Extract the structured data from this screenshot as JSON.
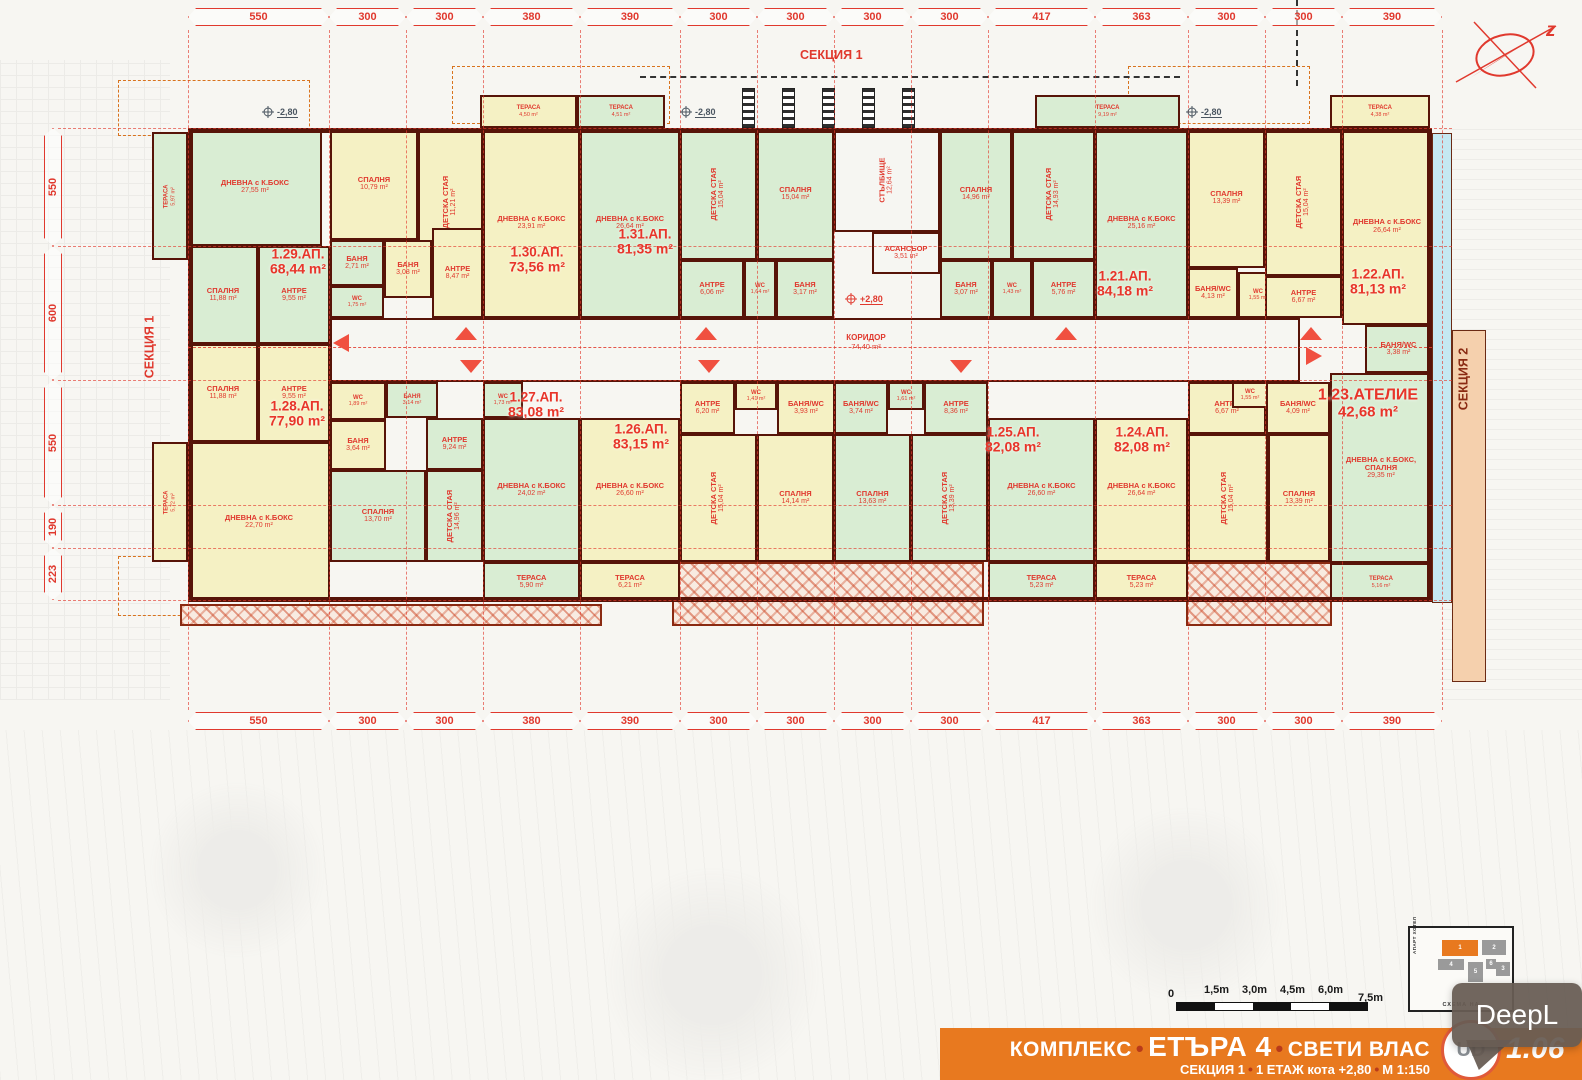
{
  "sections": {
    "top": "СЕКЦИЯ 1",
    "left": "СЕКЦИЯ 1",
    "right": "СЕКЦИЯ 2"
  },
  "north": {
    "letter": "z"
  },
  "dimensions": {
    "horizontal": [
      "550",
      "300",
      "300",
      "380",
      "390",
      "300",
      "300",
      "300",
      "300",
      "417",
      "363",
      "300",
      "300",
      "390"
    ],
    "vertical": [
      "550",
      "600",
      "550",
      "190",
      "223"
    ]
  },
  "elevations": {
    "minus": "-2,80",
    "plus": "+2,80"
  },
  "apartments": [
    {
      "id": "a29",
      "label": "1.29.АП.",
      "area": "68,44 m²"
    },
    {
      "id": "a30",
      "label": "1.30.АП.",
      "area": "73,56 m²"
    },
    {
      "id": "a31",
      "label": "1.31.АП.",
      "area": "81,35 m²"
    },
    {
      "id": "a21",
      "label": "1.21.АП.",
      "area": "84,18 m²"
    },
    {
      "id": "a22",
      "label": "1.22.АП.",
      "area": "81,13 m²"
    },
    {
      "id": "a23",
      "label": "1.23.АТЕЛИЕ",
      "area": "42,68 m²"
    },
    {
      "id": "a24",
      "label": "1.24.АП.",
      "area": "82,08 m²"
    },
    {
      "id": "a25",
      "label": "1.25.АП.",
      "area": "82,08 m²"
    },
    {
      "id": "a26",
      "label": "1.26.АП.",
      "area": "83,15 m²"
    },
    {
      "id": "a27",
      "label": "1.27.АП.",
      "area": "83,08 m²"
    },
    {
      "id": "a28",
      "label": "1.28.АП.",
      "area": "77,90 m²"
    }
  ],
  "rooms": [
    {
      "id": "ter597",
      "label": "ТЕРАСА",
      "area": "5,97 m²"
    },
    {
      "id": "r29dnev",
      "label": "ДНЕВНА с К.БОКС",
      "area": "27,55 m²"
    },
    {
      "id": "r29span",
      "label": "СПАЛНЯ",
      "area": "11,88 m²"
    },
    {
      "id": "r29antre",
      "label": "АНТРЕ",
      "area": "9,55 m²"
    },
    {
      "id": "r29banya",
      "label": "БАНЯ",
      "area": "2,71 m²"
    },
    {
      "id": "r29wc",
      "label": "WC",
      "area": "1,75 m²"
    },
    {
      "id": "r30span",
      "label": "СПАЛНЯ",
      "area": "10,79 m²"
    },
    {
      "id": "r30detska",
      "label": "ДЕТСКА СТАЯ",
      "area": "11,21 m²"
    },
    {
      "id": "r30antre",
      "label": "АНТРЕ",
      "area": "8,47 m²"
    },
    {
      "id": "r30banya",
      "label": "БАНЯ",
      "area": "3,08 m²"
    },
    {
      "id": "r30wc",
      "label": "WC",
      "area": "1,82 m²"
    },
    {
      "id": "r30ter",
      "label": "ТЕРАСА",
      "area": "4,50 m²"
    },
    {
      "id": "r30dnev",
      "label": "ДНЕВНА с К.БОКС",
      "area": "23,91 m²"
    },
    {
      "id": "r31ter",
      "label": "ТЕРАСА",
      "area": "4,51 m²"
    },
    {
      "id": "r31dnev",
      "label": "ДНЕВНА с К.БОКС",
      "area": "26,64 m²"
    },
    {
      "id": "r31detska",
      "label": "ДЕТСКА СТАЯ",
      "area": "15,04 m²"
    },
    {
      "id": "r31span",
      "label": "СПАЛНЯ",
      "area": "15,04 m²"
    },
    {
      "id": "r31antre",
      "label": "АНТРЕ",
      "area": "6,06 m²"
    },
    {
      "id": "r31wc",
      "label": "WC",
      "area": "1,64 m²"
    },
    {
      "id": "r31banya",
      "label": "БАНЯ",
      "area": "3,17 m²"
    },
    {
      "id": "stair",
      "label": "СТЪЛБИЩЕ",
      "area": "12,64 m²"
    },
    {
      "id": "lift",
      "label": "АСАНСЬОР",
      "area": "3,51 m²"
    },
    {
      "id": "corridor",
      "label": "",
      "area": ""
    },
    {
      "id": "r21span",
      "label": "СПАЛНЯ",
      "area": "14,96 m²"
    },
    {
      "id": "r21ter",
      "label": "ТЕРАСА",
      "area": "9,19 m²"
    },
    {
      "id": "r21detska",
      "label": "ДЕТСКА СТАЯ",
      "area": "14,93 m²"
    },
    {
      "id": "r21banya",
      "label": "БАНЯ",
      "area": "3,07 m²"
    },
    {
      "id": "r21wc",
      "label": "WC",
      "area": "1,43 m²"
    },
    {
      "id": "r21antre",
      "label": "АНТРЕ",
      "area": "5,76 m²"
    },
    {
      "id": "r21dnev",
      "label": "ДНЕВНА с К.БОКС",
      "area": "25,16 m²"
    },
    {
      "id": "r22span",
      "label": "СПАЛНЯ",
      "area": "13,39 m²"
    },
    {
      "id": "r22banyawc",
      "label": "БАНЯ/WC",
      "area": "4,13 m²"
    },
    {
      "id": "r22wc",
      "label": "WC",
      "area": "1,55 m²"
    },
    {
      "id": "r22detska",
      "label": "ДЕТСКА СТАЯ",
      "area": "15,04 m²"
    },
    {
      "id": "r22antre",
      "label": "АНТРЕ",
      "area": "6,67 m²"
    },
    {
      "id": "r22ter",
      "label": "ТЕРАСА",
      "area": "4,38 m²"
    },
    {
      "id": "r22dnev",
      "label": "ДНЕВНА с К.БОКС",
      "area": "26,64 m²"
    },
    {
      "id": "r23banyawc",
      "label": "БАНЯ/WC",
      "area": "3,38 m²"
    },
    {
      "id": "r23dnev",
      "label": "ДНЕВНА с К.БОКС, СПАЛНЯ",
      "area": "29,35 m²"
    },
    {
      "id": "r23ter",
      "label": "ТЕРАСА",
      "area": "5,16 m²"
    },
    {
      "id": "r28span",
      "label": "СПАЛНЯ",
      "area": "11,88 m²"
    },
    {
      "id": "r28antre",
      "label": "АНТРЕ",
      "area": "9,55 m²"
    },
    {
      "id": "r28wc",
      "label": "WC",
      "area": "1,89 m²"
    },
    {
      "id": "r28banya",
      "label": "БАНЯ",
      "area": "3,64 m²"
    },
    {
      "id": "r28detska",
      "label": "ДЕТСКА СТАЯ",
      "area": "12,15 m²"
    },
    {
      "id": "r28dnev",
      "label": "ДНЕВНА с К.БОКС",
      "area": "22,70 m²"
    },
    {
      "id": "r28ter",
      "label": "ТЕРАСА",
      "area": "5,72 m²"
    },
    {
      "id": "r27banya",
      "label": "БАНЯ",
      "area": "3,14 m²"
    },
    {
      "id": "r27antre",
      "label": "АНТРЕ",
      "area": "9,24 m²"
    },
    {
      "id": "r27span",
      "label": "СПАЛНЯ",
      "area": "13,70 m²"
    },
    {
      "id": "r27detska",
      "label": "ДЕТСКА СТАЯ",
      "area": "14,96 m²"
    },
    {
      "id": "r27wc",
      "label": "WC",
      "area": "1,73 m²"
    },
    {
      "id": "r27dnev",
      "label": "ДНЕВНА с К.БОКС",
      "area": "24,02 m²"
    },
    {
      "id": "r27ter",
      "label": "ТЕРАСА",
      "area": "5,90 m²"
    },
    {
      "id": "r26dnev",
      "label": "ДНЕВНА с К.БОКС",
      "area": "26,60 m²"
    },
    {
      "id": "r26ter",
      "label": "ТЕРАСА",
      "area": "6,21 m²"
    },
    {
      "id": "r26antre",
      "label": "АНТРЕ",
      "area": "6,20 m²"
    },
    {
      "id": "r26detska",
      "label": "ДЕТСКА СТАЯ",
      "area": "15,04 m²"
    },
    {
      "id": "r26span",
      "label": "СПАЛНЯ",
      "area": "14,14 m²"
    },
    {
      "id": "r26wc",
      "label": "WC",
      "area": "1,41 m²"
    },
    {
      "id": "r26banyawc",
      "label": "БАНЯ/WC",
      "area": "3,93 m²"
    },
    {
      "id": "r25banyawc",
      "label": "БАНЯ/WC",
      "area": "3,74 m²"
    },
    {
      "id": "r25wc",
      "label": "WC",
      "area": "1,61 m²"
    },
    {
      "id": "r25antre",
      "label": "АНТРЕ",
      "area": "8,36 m²"
    },
    {
      "id": "r25span",
      "label": "СПАЛНЯ",
      "area": "13,63 m²"
    },
    {
      "id": "r25detska",
      "label": "ДЕТСКА СТАЯ",
      "area": "13,39 m²"
    },
    {
      "id": "r25dnev",
      "label": "ДНЕВНА с К.БОКС",
      "area": "26,60 m²"
    },
    {
      "id": "r25ter",
      "label": "ТЕРАСА",
      "area": "5,23 m²"
    },
    {
      "id": "r24dnev",
      "label": "ДНЕВНА с К.БОКС",
      "area": "26,64 m²"
    },
    {
      "id": "r24ter",
      "label": "ТЕРАСА",
      "area": "5,23 m²"
    },
    {
      "id": "r24antre",
      "label": "АНТРЕ",
      "area": "6,67 m²"
    },
    {
      "id": "r24wc",
      "label": "WC",
      "area": "1,55 m²"
    },
    {
      "id": "r24banyawc",
      "label": "БАНЯ/WC",
      "area": "4,09 m²"
    },
    {
      "id": "r24detska",
      "label": "ДЕТСКА СТАЯ",
      "area": "15,04 m²"
    },
    {
      "id": "r24span",
      "label": "СПАЛНЯ",
      "area": "13,39 m²"
    }
  ],
  "corridor": {
    "label": "КОРИДОР",
    "area": "74,40 m²"
  },
  "scalebar": {
    "labels": [
      "0",
      "1,5m",
      "3,0m",
      "4,5m",
      "6,0m",
      "7,5m"
    ]
  },
  "keyplan": {
    "caption": "СХЕМА НА",
    "hotel_label": "АПАРТ ХОТЕЛ",
    "buildings": [
      "1",
      "2",
      "3",
      "4",
      "5",
      "6"
    ]
  },
  "footer": {
    "complex": "КОМПЛЕКС",
    "name": "ЕТЪРА 4",
    "city": "СВЕТИ ВЛАС",
    "sub": [
      "СЕКЦИЯ 1",
      "1 ЕТАЖ кота +2,80",
      "М 1:150"
    ],
    "page": "1.06"
  },
  "overlay": {
    "deepl": "DeepL"
  },
  "colors": {
    "accent_red": "#e0392e",
    "wall": "#571408",
    "room_green": "#d9edd3",
    "room_yellow": "#f5f1c4",
    "footer_orange": "#e8791f",
    "cyan_strip": "#c5e9f2",
    "peach_strip": "#f5d0ad"
  }
}
